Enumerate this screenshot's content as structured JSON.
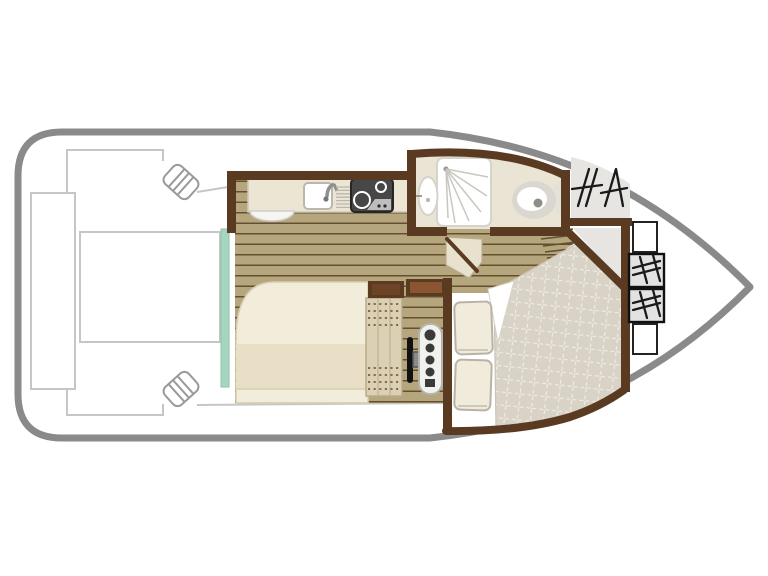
{
  "diagram": {
    "title": "boat-floor-plan",
    "colors": {
      "hull": "#8a8a8a",
      "deckLine": "#c6c6c6",
      "wall": "#5b3a22",
      "wallInner": "#8a5530",
      "wood": "#b5a67d",
      "woodLine": "#64502f",
      "counter": "#ece5d3",
      "counterEdge": "#cfc8b6",
      "teal": "#a5d6bf",
      "stove": "#474747",
      "stoveEdge": "#262626",
      "stoveLight": "#bdbdbd",
      "bedCream": "#f2edda",
      "bedMid": "#e8dfc6",
      "bedEdge": "#d6cdb2",
      "blanket": "#d9d2c6",
      "quiltLine": "#f1ede5",
      "pillow": "#f0ebdb",
      "pillowEdge": "#b8b3a6",
      "bath": "#eae4d4",
      "fixture": "#ffffff",
      "fixtureEdge": "#d5d3ca",
      "grayFix": "#d9d7cf",
      "deckGray": "#e6e5e1",
      "hatchBox": "#e2e2e2",
      "ink": "#1a1a1a",
      "seat": "#dbd0b4",
      "seatEdge": "#b9ac8c",
      "stitch": "#6b4a2a",
      "panel": "#f1f1ed",
      "panelEdge": "#b5b5b0",
      "gauge": "#3a3a3a",
      "metal": "#8f8f8f"
    },
    "fixtures": [
      "hull",
      "stern-bench",
      "stern-table",
      "mooring-cleat",
      "galley-counter",
      "sink",
      "faucet",
      "drainboard",
      "stove",
      "fold-out-table",
      "sliding-door",
      "saloon-double-bed",
      "helm-seat",
      "steering-wheel",
      "instrument-panel",
      "storage-cabinet",
      "bathroom",
      "shower",
      "washbasin",
      "toilet",
      "bathroom-door",
      "companionway-steps",
      "v-berth-bed",
      "quilted-blanket",
      "pillow",
      "anchor-locker",
      "deck-hatch",
      "bow-window"
    ]
  }
}
